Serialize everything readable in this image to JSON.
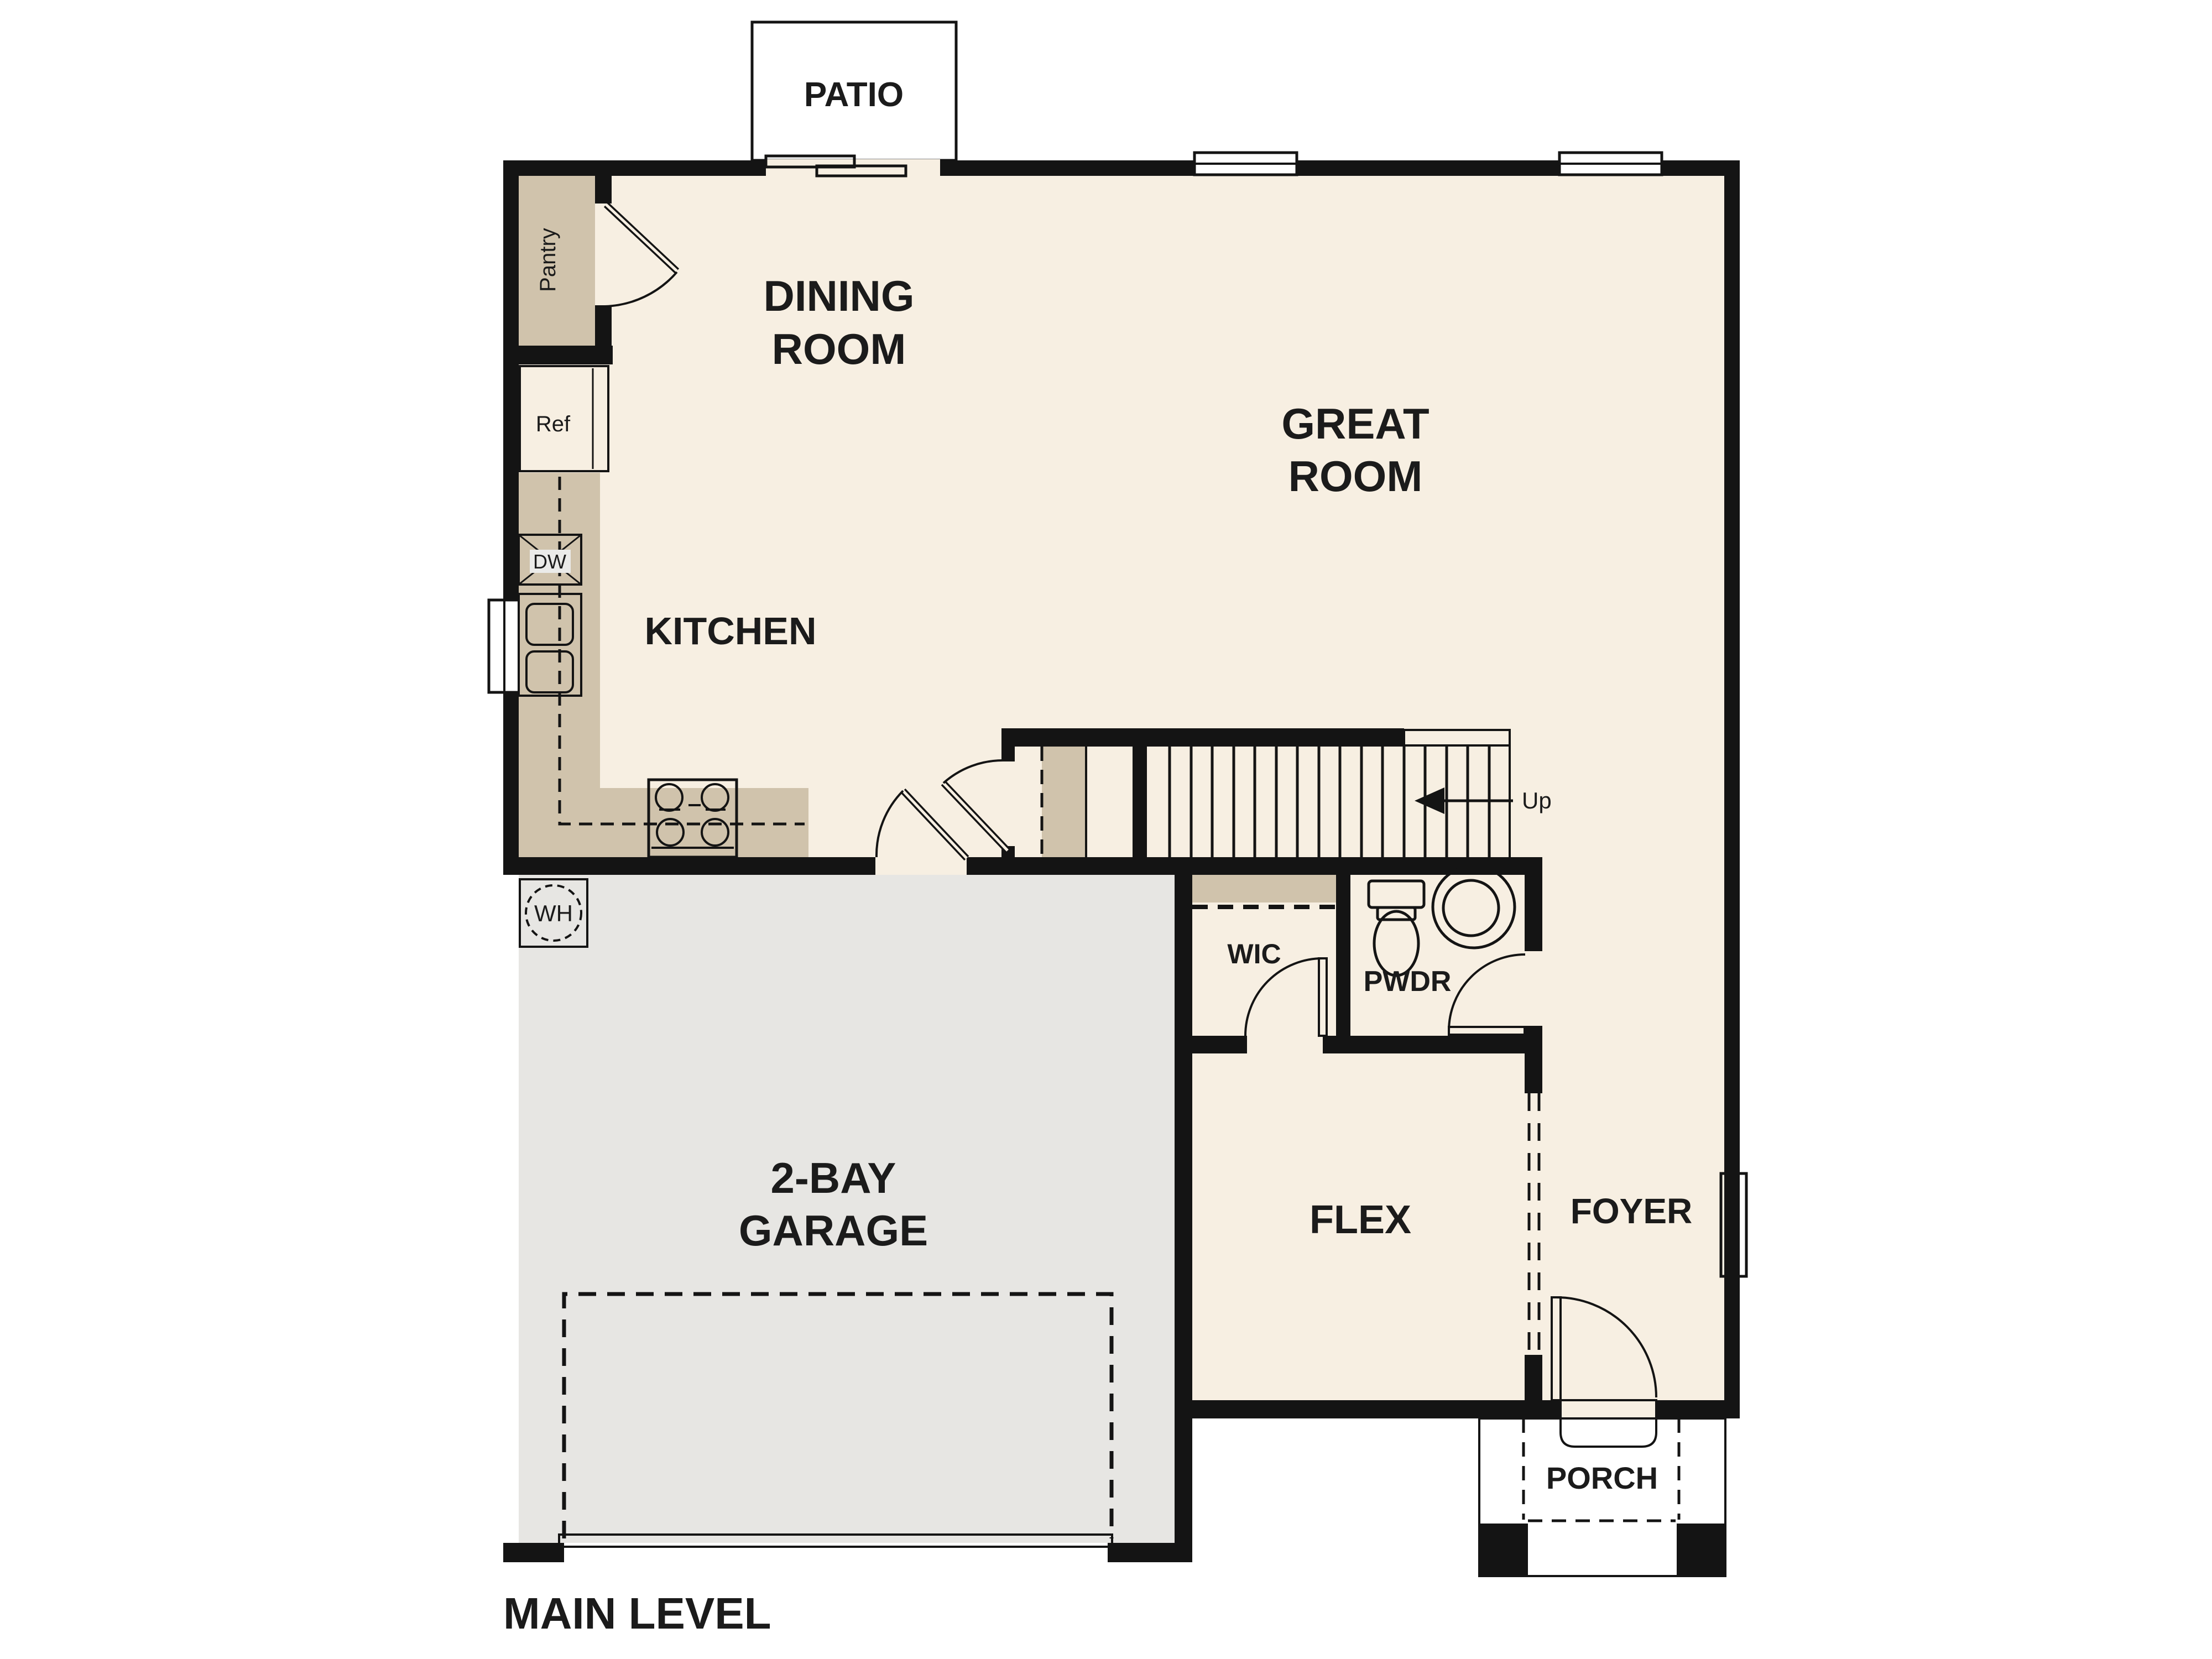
{
  "plan_title": "MAIN LEVEL",
  "colors": {
    "floor": "#f7efe2",
    "wall": "#141414",
    "counter": "#d0c3ac",
    "garage_floor": "#e7e6e3",
    "patio_floor": "#e9e8e6",
    "porch_floor": "#e4e3e1",
    "appliance": "#ebebe9",
    "sink_blue": "#a9c8e8",
    "background": "#ffffff"
  },
  "rooms": {
    "patio": {
      "label": "PATIO"
    },
    "dining": {
      "line1": "DINING",
      "line2": "ROOM"
    },
    "great": {
      "line1": "GREAT",
      "line2": "ROOM"
    },
    "kitchen": {
      "label": "KITCHEN"
    },
    "garage": {
      "line1": "2-BAY",
      "line2": "GARAGE"
    },
    "wic": {
      "label": "WIC"
    },
    "pwdr": {
      "label": "PWDR"
    },
    "flex": {
      "label": "FLEX"
    },
    "foyer": {
      "label": "FOYER"
    },
    "porch": {
      "label": "PORCH"
    }
  },
  "fixtures": {
    "pantry": "Pantry",
    "refrigerator": "Ref",
    "dishwasher": "DW",
    "water_heater": "WH",
    "stair_direction": "Up"
  }
}
